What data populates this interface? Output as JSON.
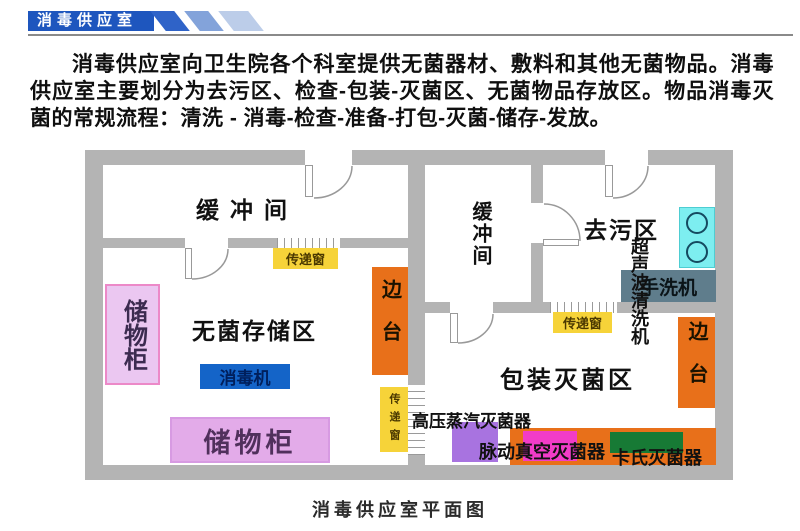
{
  "header": {
    "title": "消毒供应室"
  },
  "intro": {
    "text": "消毒供应室向卫生院各个科室提供无菌器材、敷料和其他无菌物品。消毒供应室主要划分为去污区、检查-包装-灭菌区、无菌物品存放区。物品消毒灭菌的常规流程：清洗 - 消毒-检查-准备-打包-灭菌-储存-发放。"
  },
  "floorplan": {
    "rooms": {
      "buffer_left": "缓冲间",
      "buffer_right": "缓冲间",
      "decontamination": "去污区",
      "sterile_storage": "无菌存储区",
      "packing_sterilization": "包装灭菌区"
    },
    "equipment": {
      "cabinet_left": "储物柜",
      "cabinet_bottom": "储物柜",
      "disinfector": "消毒机",
      "side_table_left": "边台",
      "side_table_right": "边台",
      "pass_window_left": "传递窗",
      "pass_window_mid": "传递窗",
      "pass_window_right": "传递窗",
      "ultrasonic_cleaner": "超声波清洗机",
      "hand_washer": "手洗机",
      "steam_sterilizer": "高压蒸汽灭菌器",
      "pulse_vacuum_sterilizer": "脉动真空灭菌器",
      "cassette_sterilizer": "卡氏灭菌器"
    },
    "caption": "消毒供应室平面图"
  },
  "colors": {
    "banner_blue": "#1e56be",
    "stripe_dark": "#2f63c8",
    "stripe_mid": "#83a3da",
    "stripe_light": "#bccde9",
    "wall_gray": "#b4b4b4",
    "cabinet_purple": "#ebc7f1",
    "cabinet_bottom_purple": "#e3abe9",
    "disinfector_blue": "#1464c8",
    "side_table_orange": "#e8701a",
    "pass_window_yellow": "#f6d339",
    "ultrasonic_cyan": "#7deef0",
    "hand_washer_slate": "#5f7d8c",
    "autoclave_purple": "#a873e0",
    "pulse_vacuum_magenta": "#f23cc8",
    "cassette_green": "#177a35"
  }
}
